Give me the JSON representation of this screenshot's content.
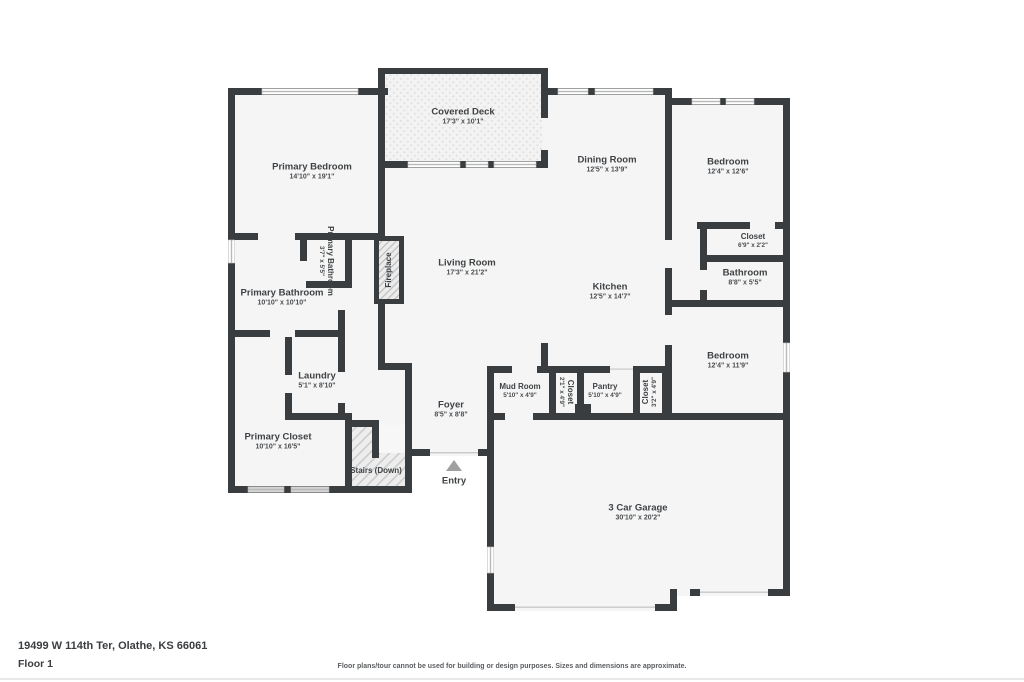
{
  "page": {
    "address": "19499 W 114th Ter, Olathe, KS 66061",
    "floor_label": "Floor 1",
    "disclaimer": "Floor plans/tour cannot be used for building or design purposes. Sizes and dimensions are approximate."
  },
  "colors": {
    "wall": "#3a3d40",
    "room_fill": "#f5f5f5",
    "label_text": "#3f4245",
    "entry_arrow": "#a0a0a0",
    "background": "#ffffff"
  },
  "rooms": [
    {
      "id": "primary-bedroom",
      "name": "Primary Bedroom",
      "dims": "14'10\" x 19'1\""
    },
    {
      "id": "covered-deck",
      "name": "Covered Deck",
      "dims": "17'3\" x 10'1\""
    },
    {
      "id": "dining-room",
      "name": "Dining Room",
      "dims": "12'5\" x 13'9\""
    },
    {
      "id": "bedroom-upper",
      "name": "Bedroom",
      "dims": "12'4\" x 12'6\""
    },
    {
      "id": "closet-upper",
      "name": "Closet",
      "dims": "6'9\" x 2'2\""
    },
    {
      "id": "bathroom",
      "name": "Bathroom",
      "dims": "8'8\" x 5'5\""
    },
    {
      "id": "bedroom-lower",
      "name": "Bedroom",
      "dims": "12'4\" x 11'9\""
    },
    {
      "id": "kitchen",
      "name": "Kitchen",
      "dims": "12'5\" x 14'7\""
    },
    {
      "id": "living-room",
      "name": "Living Room",
      "dims": "17'3\" x 21'2\""
    },
    {
      "id": "primary-bathroom-toilet",
      "name": "Primary Bathroom",
      "dims": "3'7\" x 5'5\""
    },
    {
      "id": "primary-bathroom",
      "name": "Primary Bathroom",
      "dims": "10'10\" x 10'10\""
    },
    {
      "id": "laundry",
      "name": "Laundry",
      "dims": "5'1\" x 8'10\""
    },
    {
      "id": "primary-closet",
      "name": "Primary Closet",
      "dims": "10'10\" x 16'5\""
    },
    {
      "id": "stairs",
      "name": "Stairs (Down)"
    },
    {
      "id": "foyer",
      "name": "Foyer",
      "dims": "8'5\" x 8'8\""
    },
    {
      "id": "mud-room",
      "name": "Mud Room",
      "dims": "5'10\" x 4'9\""
    },
    {
      "id": "closet-mud",
      "name": "Closet",
      "dims": "2'1\" x 4'9\""
    },
    {
      "id": "pantry",
      "name": "Pantry",
      "dims": "5'10\" x 4'9\""
    },
    {
      "id": "closet-pantry",
      "name": "Closet",
      "dims": "3'2\" x 4'9\""
    },
    {
      "id": "garage",
      "name": "3 Car Garage",
      "dims": "30'10\" x 20'2\""
    },
    {
      "id": "fireplace",
      "name": "Fireplace"
    },
    {
      "id": "entry",
      "name": "Entry"
    }
  ]
}
